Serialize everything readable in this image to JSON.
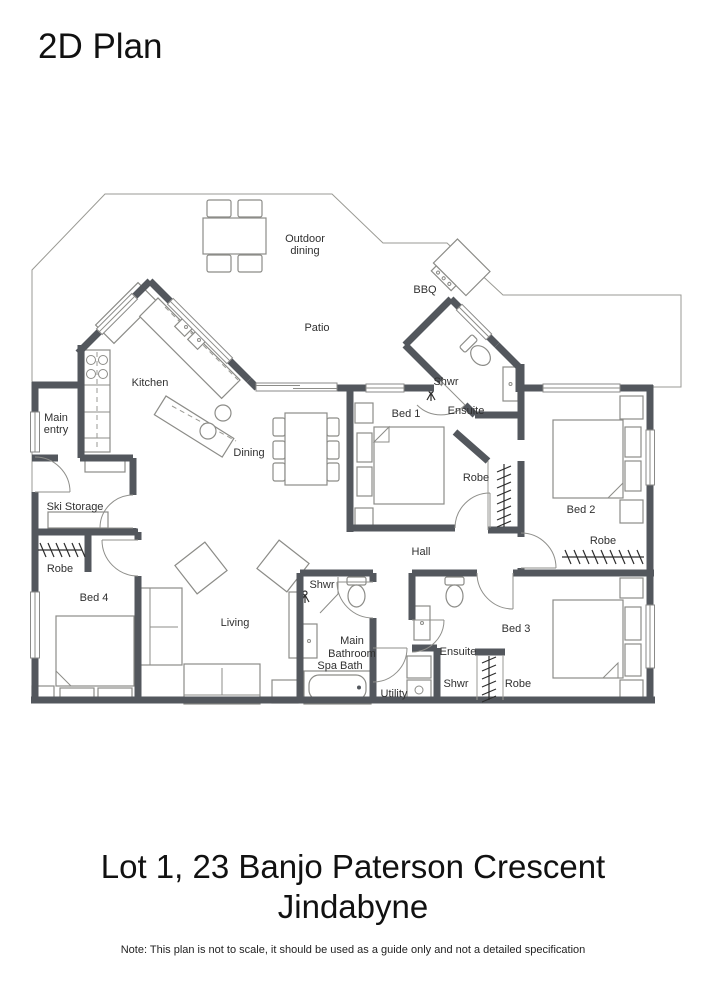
{
  "title": "2D Plan",
  "address": {
    "line1": "Lot 1, 23 Banjo Paterson Crescent",
    "line2": "Jindabyne"
  },
  "note": "Note: This plan is not to scale, it should be used as a guide only and not a detailed specification",
  "colors": {
    "wall": "#53575d",
    "floor": "#e4e4de",
    "outline": "#9a9a94"
  },
  "labels": {
    "outdoor_dining_1": "Outdoor",
    "outdoor_dining_2": "dining",
    "bbq": "BBQ",
    "patio": "Patio",
    "kitchen": "Kitchen",
    "main_entry_1": "Main",
    "main_entry_2": "entry",
    "dining": "Dining",
    "bed1": "Bed 1",
    "shwr_ensuite1": "Shwr",
    "ensuite1": "Ensuite",
    "ski_storage": "Ski Storage",
    "robe_hall": "Robe",
    "bed2": "Bed 2",
    "robe_bed2": "Robe",
    "hall": "Hall",
    "robe_bed4": "Robe",
    "bed4": "Bed 4",
    "living": "Living",
    "shwr_bath": "Shwr",
    "main_bathroom_1": "Main",
    "main_bathroom_2": "Bathroom",
    "spa_bath": "Spa Bath",
    "utility": "Utility",
    "ensuite2": "Ensuite",
    "shwr_ensuite2": "Shwr",
    "robe_bed3": "Robe",
    "bed3": "Bed 3"
  }
}
